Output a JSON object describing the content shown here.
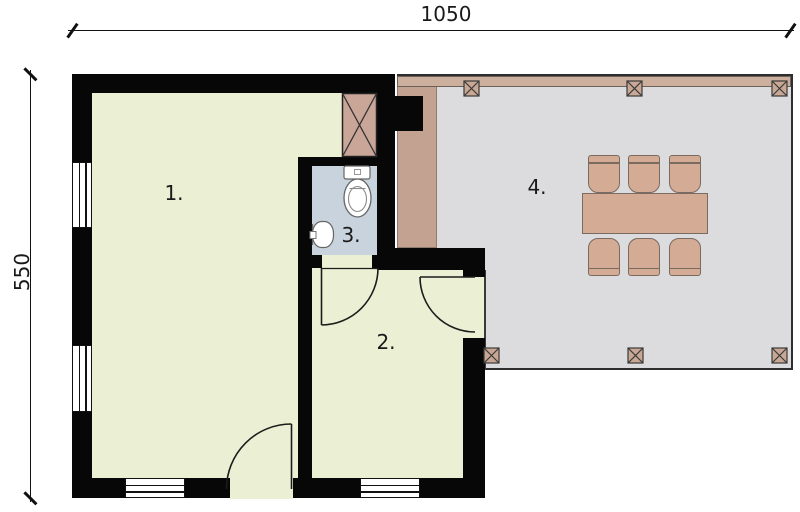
{
  "plan": {
    "dimensions": {
      "width_label": "1050",
      "height_label": "550"
    },
    "rooms": [
      {
        "number": "1."
      },
      {
        "number": "2."
      },
      {
        "number": "3."
      },
      {
        "number": "4."
      }
    ],
    "colors": {
      "wall": "#070707",
      "room_floor": "#ebefd3",
      "bathroom_floor": "#c8d3dd",
      "terrace_floor": "#dcdcde",
      "deck_wood": "#c3a292",
      "pergola_beam": "#ccaf9d",
      "furniture": "#d4ab94",
      "chimney": "#c9a698",
      "background": "#ffffff"
    }
  }
}
